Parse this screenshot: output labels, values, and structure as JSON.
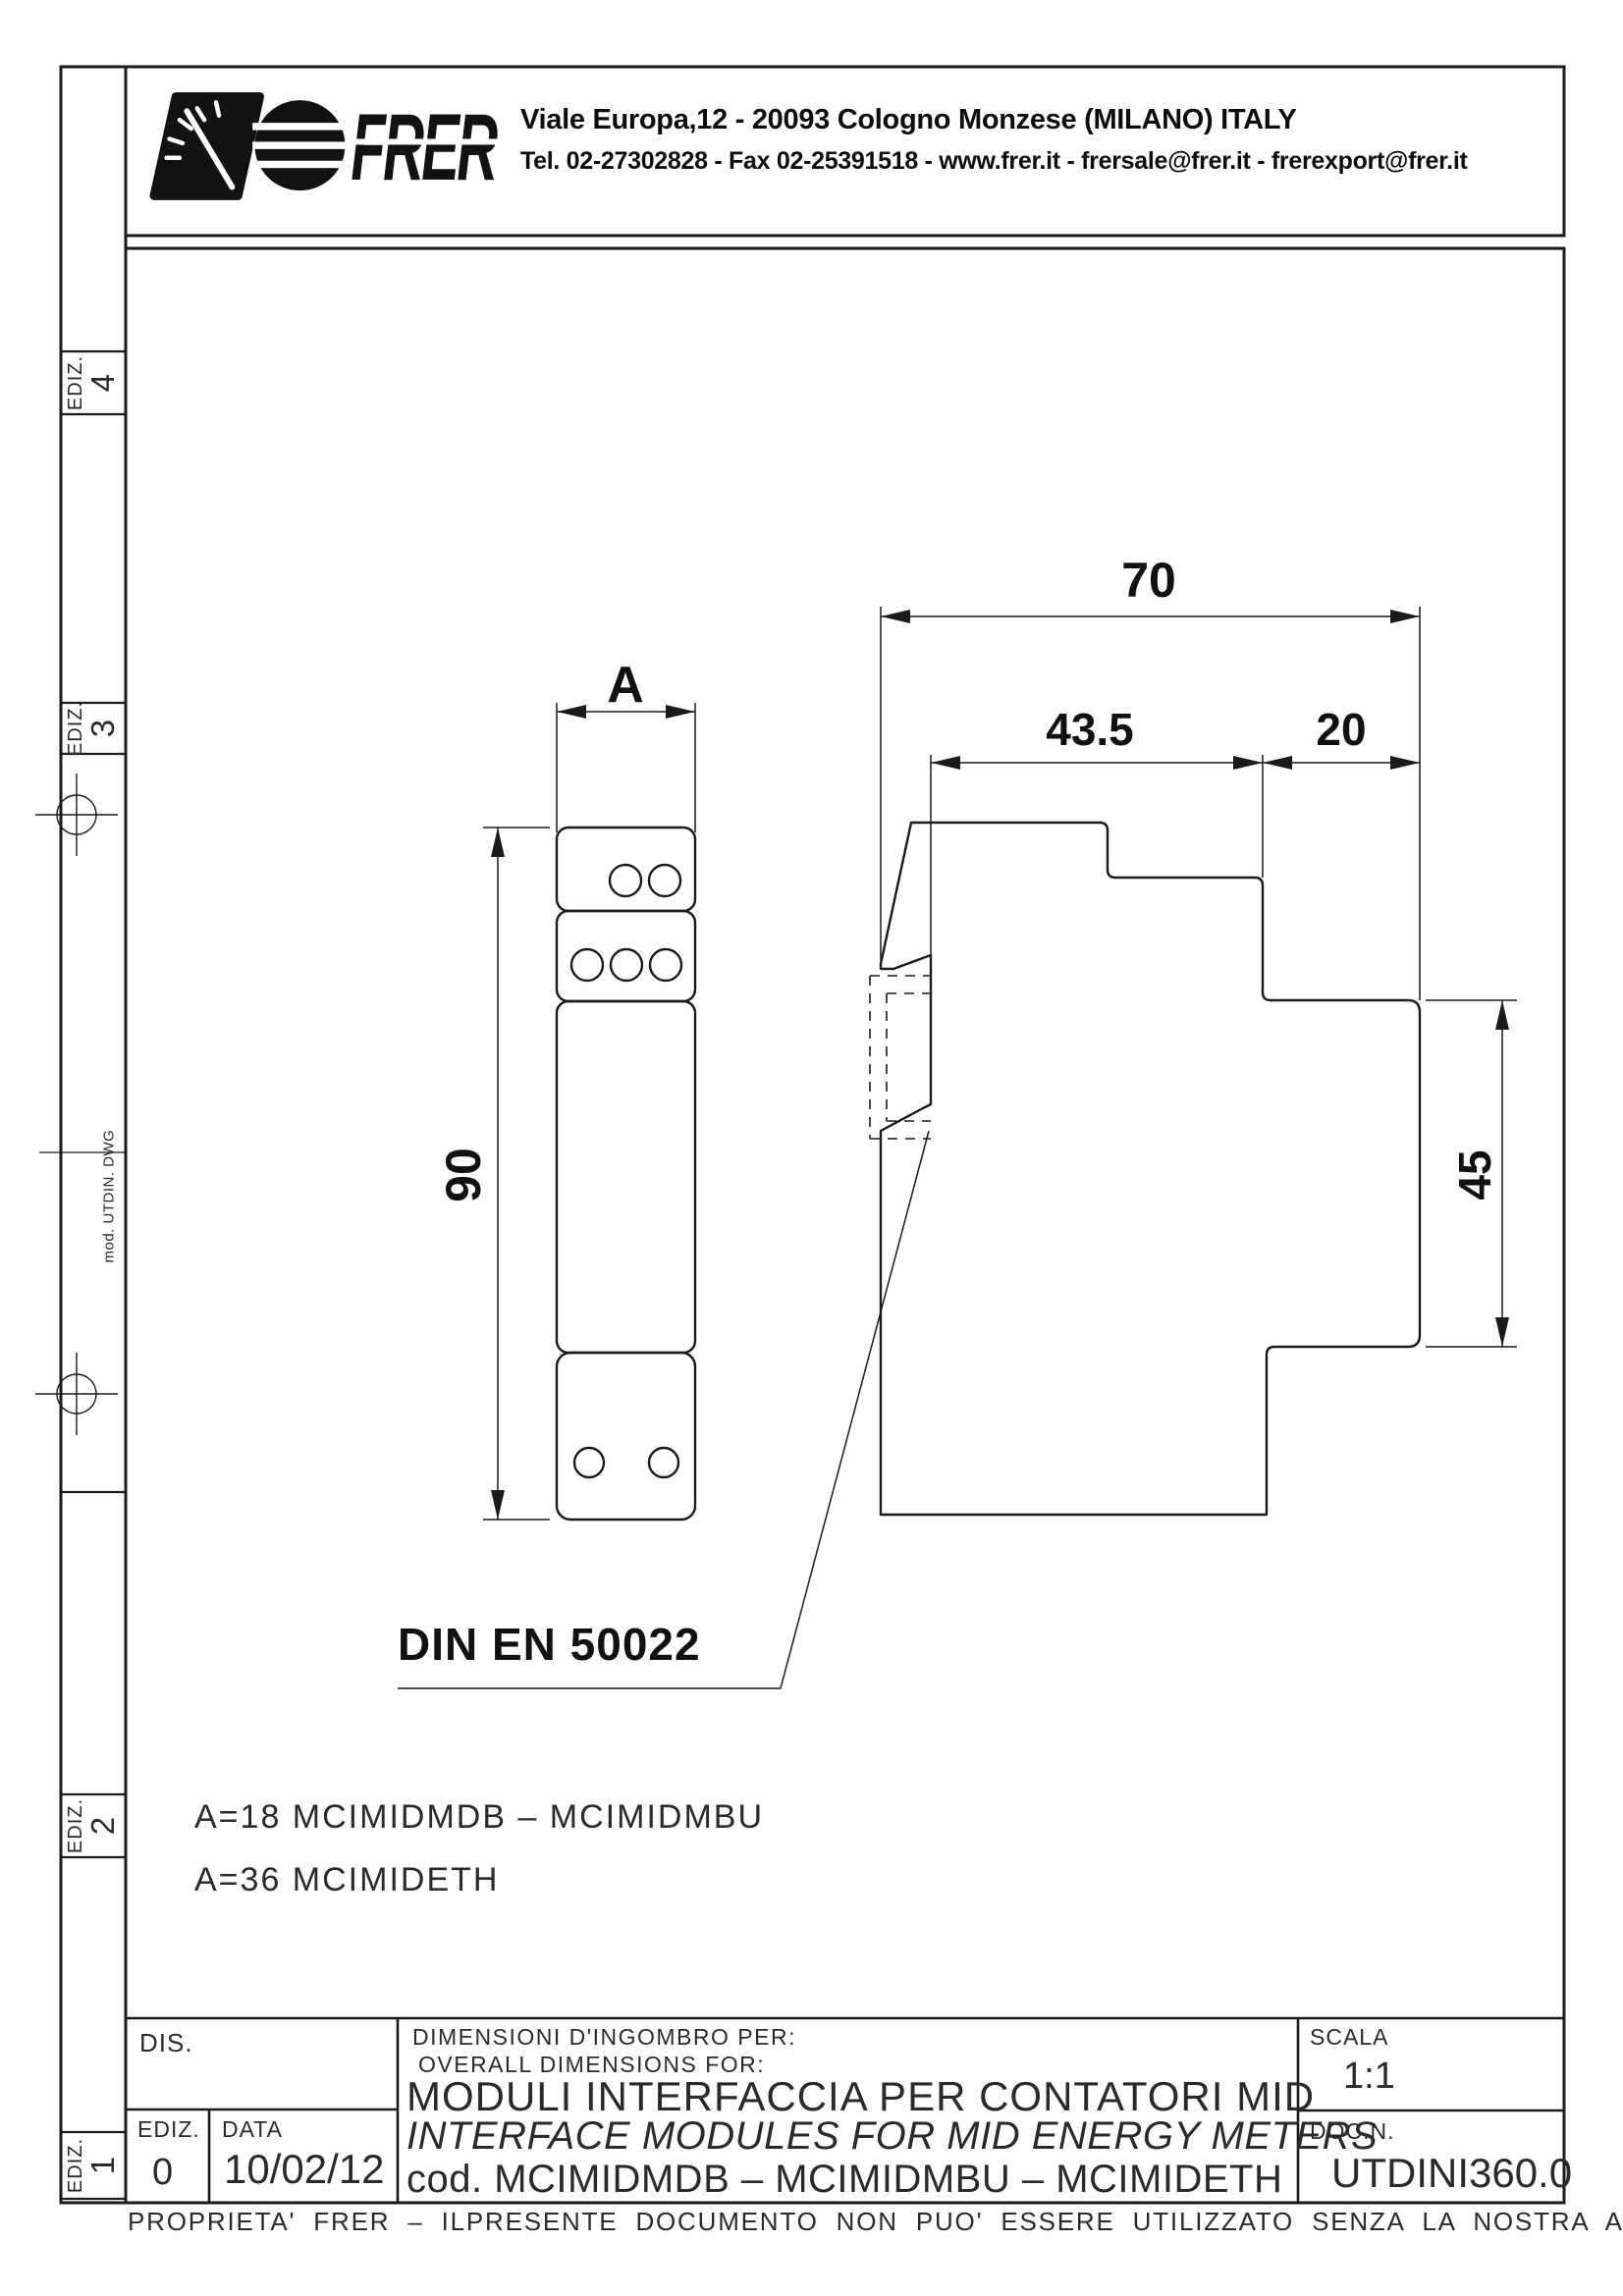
{
  "header": {
    "logo_text": "FRER",
    "address_line1": "Viale Europa,12 - 20093 Cologno Monzese (MILANO) ITALY",
    "address_line2": "Tel. 02-27302828 - Fax 02-25391518 - www.frer.it - frersale@frer.it - frerexport@frer.it"
  },
  "margin": {
    "ediz_markers": [
      {
        "label": "EDIZ.",
        "number": "4"
      },
      {
        "label": "EDIZ.",
        "number": "3"
      },
      {
        "label": "EDIZ.",
        "number": "2"
      },
      {
        "label": "EDIZ.",
        "number": "1"
      }
    ],
    "note": "mod. UTDIN. DWG"
  },
  "drawing": {
    "dim_a": "A",
    "dim_total_depth": "70",
    "dim_front_depth": "43.5",
    "dim_terminal_depth": "20",
    "dim_height": "90",
    "dim_rail_face": "45",
    "din_label": "DIN EN 50022",
    "note_line1": "A=18 MCIMIDMDB – MCIMIDMBU",
    "note_line2": "A=36 MCIMIDETH"
  },
  "title_block": {
    "dis_label": "DIS.",
    "ediz_label": "EDIZ.",
    "ediz_value": "0",
    "data_label": "DATA",
    "data_value": "10/02/12",
    "subject_it": "DIMENSIONI D'INGOMBRO PER:",
    "subject_en": "OVERALL DIMENSIONS FOR:",
    "title_it": "MODULI INTERFACCIA PER CONTATORI MID",
    "title_en": "INTERFACE MODULES FOR MID ENERGY METERS",
    "code_line": "cod. MCIMIDMDB – MCIMIDMBU – MCIMIDETH",
    "scala_label": "SCALA",
    "scala_value": "1:1",
    "docn_label": "DOC.N.",
    "docn_value": "UTDINI360.0"
  },
  "footer": {
    "disclaimer": "PROPRIETA' FRER – ILPRESENTE DOCUMENTO NON PUO' ESSERE UTILIZZATO SENZA LA NOSTRA AUTORIZZAZIONE"
  }
}
